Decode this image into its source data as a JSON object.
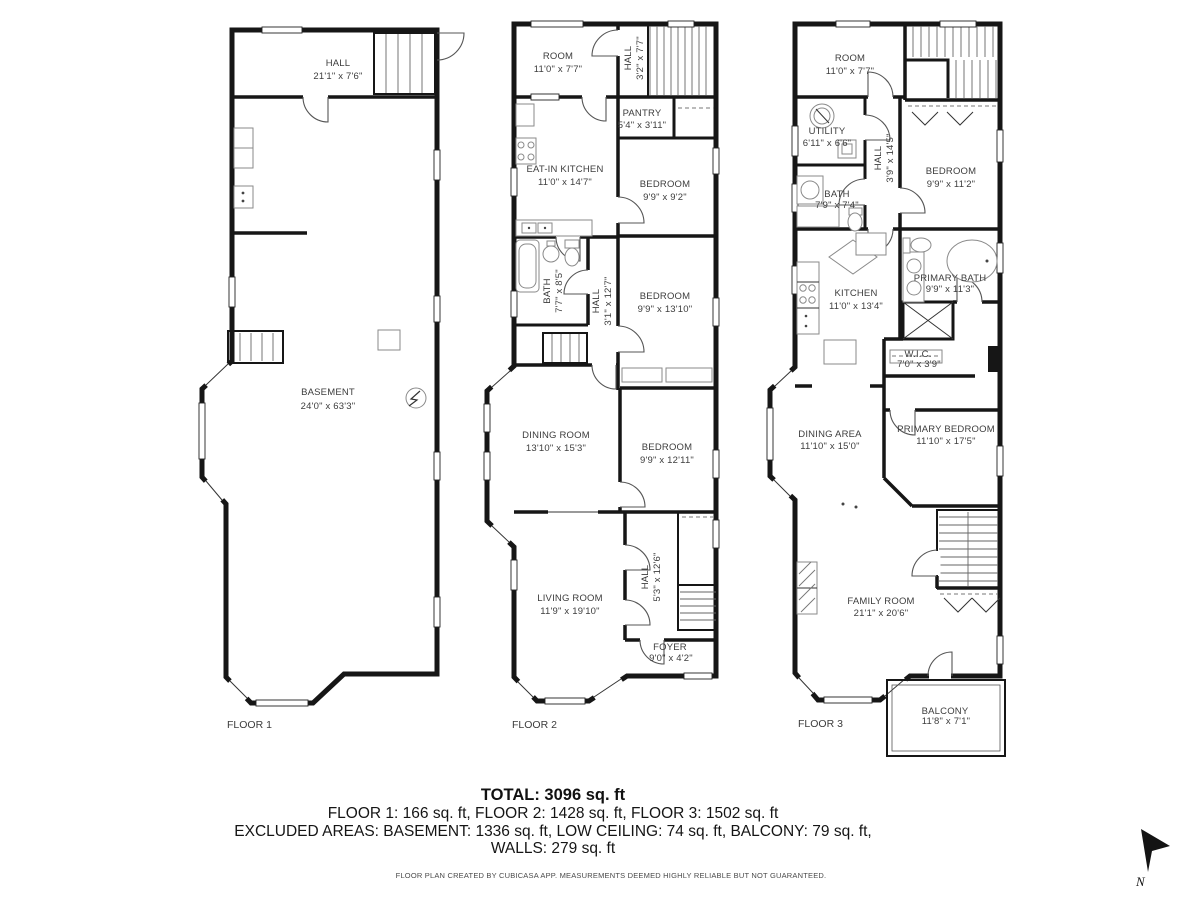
{
  "floors": [
    {
      "label": "FLOOR 1",
      "rooms": [
        {
          "name": "HALL",
          "dims": "21'1\" x 7'6\""
        },
        {
          "name": "BASEMENT",
          "dims": "24'0\" x 63'3\""
        }
      ]
    },
    {
      "label": "FLOOR 2",
      "rooms": [
        {
          "name": "ROOM",
          "dims": "11'0\" x 7'7\""
        },
        {
          "name": "HALL",
          "dims": "3'2\" x 7'7\""
        },
        {
          "name": "PANTRY",
          "dims": "5'4\" x 3'11\""
        },
        {
          "name": "EAT-IN KITCHEN",
          "dims": "11'0\" x 14'7\""
        },
        {
          "name": "BEDROOM",
          "dims": "9'9\" x 9'2\""
        },
        {
          "name": "BATH",
          "dims": "7'7\" x 8'5\""
        },
        {
          "name": "HALL",
          "dims": "3'1\" x 12'7\""
        },
        {
          "name": "BEDROOM",
          "dims": "9'9\" x 13'10\""
        },
        {
          "name": "DINING ROOM",
          "dims": "13'10\" x 15'3\""
        },
        {
          "name": "BEDROOM",
          "dims": "9'9\" x 12'11\""
        },
        {
          "name": "LIVING ROOM",
          "dims": "11'9\" x 19'10\""
        },
        {
          "name": "HALL",
          "dims": "5'3\" x 12'6\""
        },
        {
          "name": "FOYER",
          "dims": "9'0\" x 4'2\""
        }
      ]
    },
    {
      "label": "FLOOR 3",
      "rooms": [
        {
          "name": "ROOM",
          "dims": "11'0\" x 7'7\""
        },
        {
          "name": "UTILITY",
          "dims": "6'11\" x 6'6\""
        },
        {
          "name": "HALL",
          "dims": "3'9\" x 14'5\""
        },
        {
          "name": "BEDROOM",
          "dims": "9'9\" x 11'2\""
        },
        {
          "name": "BATH",
          "dims": "7'9\" x 7'4\""
        },
        {
          "name": "KITCHEN",
          "dims": "11'0\" x 13'4\""
        },
        {
          "name": "PRIMARY BATH",
          "dims": "9'9\" x 11'3\""
        },
        {
          "name": "W.I.C.",
          "dims": "7'0\" x 3'9\""
        },
        {
          "name": "DINING AREA",
          "dims": "11'10\" x 15'0\""
        },
        {
          "name": "PRIMARY BEDROOM",
          "dims": "11'10\" x 17'5\""
        },
        {
          "name": "FAMILY ROOM",
          "dims": "21'1\" x 20'6\""
        },
        {
          "name": "BALCONY",
          "dims": "11'8\" x 7'1\""
        }
      ]
    }
  ],
  "summary": {
    "total": "TOTAL: 3096 sq. ft",
    "floors_line": "FLOOR 1: 166 sq. ft, FLOOR 2: 1428 sq. ft, FLOOR 3: 1502 sq. ft",
    "excluded_line": "EXCLUDED AREAS: BASEMENT: 1336 sq. ft, LOW CEILING: 74 sq. ft, BALCONY: 79 sq. ft,",
    "walls_line": "WALLS: 279 sq. ft"
  },
  "disclaimer": "FLOOR PLAN CREATED BY CUBICASA APP. MEASUREMENTS DEEMED HIGHLY RELIABLE BUT NOT GUARANTEED.",
  "compass": {
    "label": "N"
  }
}
